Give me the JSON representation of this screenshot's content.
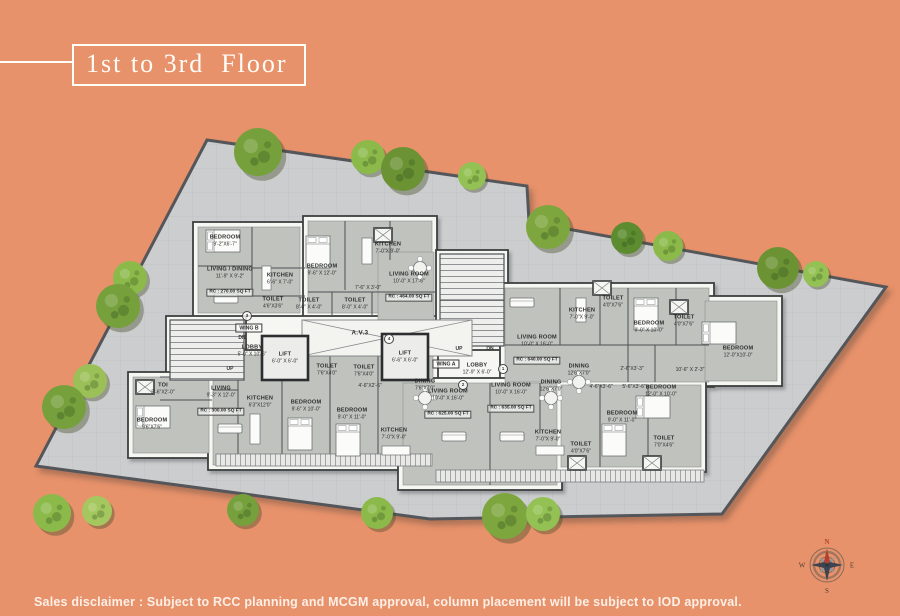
{
  "title": {
    "text": "1st to 3rd  Floor"
  },
  "disclaimer": {
    "text": "Sales disclaimer : Subject to RCC planning and MCGM approval, column placement will be subject to IOD approval."
  },
  "compass": {
    "n": "N",
    "e": "E",
    "s": "S",
    "w": "W"
  },
  "colors": {
    "background": "#e8926b",
    "plot_fill": "#cbcdcf",
    "building_fill": "#f6f6f3",
    "room_fill": "#bfc2bd",
    "wall": "#4e5054",
    "tree_greens": [
      "#76a03c",
      "#8cba4a",
      "#6b9334",
      "#93c153",
      "#7ea63f",
      "#9bc057"
    ],
    "accent_red": "#b5412f"
  },
  "plan": {
    "wing_a_label": "WING A",
    "wing_b_label": "WING B",
    "atrium_label": "A.V.3",
    "stair": {
      "up": "UP",
      "dn": "DN"
    },
    "door_tags": [
      "1",
      "2",
      "3",
      "4"
    ],
    "rooms": [
      {
        "name": "BEDROOM",
        "dims": "9'-2\"X6'-7\""
      },
      {
        "name": "LIVING / DINING",
        "dims": "11'-9\" X 9'-2\"",
        "area": "RC : 270.00 SQ FT"
      },
      {
        "name": "KITCHEN",
        "dims": "6'-6\" X 7'-0\""
      },
      {
        "name": "TOILET",
        "dims": "4'6\"X3'6\""
      },
      {
        "name": "BEDROOM",
        "dims": "9'-6\" X 12'-0\""
      },
      {
        "name": "KITCHEN",
        "dims": "7'-0\"X 9'-0\""
      },
      {
        "name": "TOILET",
        "dims": "8'-6\" X 4'-0\""
      },
      {
        "name": "TOILET",
        "dims": "8'-0\" X 4'-0\""
      },
      {
        "name": "",
        "dims": "7'-6\" X 3'-0\""
      },
      {
        "name": "LIVING ROOM",
        "dims": "10'-0\" X 17'-6\"",
        "area": "RC : 464.00 SQ FT"
      },
      {
        "name": "LOBBY",
        "dims": "5'-0\" X 10'-6\""
      },
      {
        "name": "LIFT",
        "dims": "6'-0\" X 6'-0\""
      },
      {
        "name": "TOILET",
        "dims": "7'6\"X4'0\""
      },
      {
        "name": "TOILET",
        "dims": "7'6\"X4'0\""
      },
      {
        "name": "LIFT",
        "dims": "6'-6\" X 6'-0\""
      },
      {
        "name": "LOBBY",
        "dims": "12'-9\" X 6'-0\""
      },
      {
        "name": "KITCHEN",
        "dims": "7'-0\"X 9'-0\""
      },
      {
        "name": "TOILET",
        "dims": "4'0\"X7'6\""
      },
      {
        "name": "BEDROOM",
        "dims": "9'-0\" X 10'-0\""
      },
      {
        "name": "LIVING ROOM",
        "dims": "10'-0\" X 16'-0\"",
        "area": "RC : 640.00 SQ FT"
      },
      {
        "name": "DINING",
        "dims": "12'6\"X7'0\""
      },
      {
        "name": "TOILET",
        "dims": "4'0\"X7'6\""
      },
      {
        "name": "BEDROOM",
        "dims": "12'-0\"X10'-0\""
      },
      {
        "name": "",
        "dims": "2'-6\"X3'-3\""
      },
      {
        "name": "",
        "dims": "10'-6\" X 2'-3\""
      },
      {
        "name": "BEDROOM",
        "dims": "12'-0\" X 10'-0\""
      },
      {
        "name": "BEDROOM",
        "dims": "9'-0\" X 11'-0\""
      },
      {
        "name": "TOILET",
        "dims": "7'0\"X4'6\""
      },
      {
        "name": "TOILET",
        "dims": "4'0\"X7'6\""
      },
      {
        "name": "",
        "dims": "4'-6\"X3'-6\""
      },
      {
        "name": "",
        "dims": "5'-6\"X3'-6\""
      },
      {
        "name": "TOI",
        "dims": "5'-6\"X2'-0\""
      },
      {
        "name": "BEDROOM",
        "dims": "9'6\"X7'6\""
      },
      {
        "name": "LIVING",
        "dims": "9'-3\" X 12'-0\"",
        "area": "RC : 300.00 SQ FT"
      },
      {
        "name": "KITCHEN",
        "dims": "6'3\"X12'0\""
      },
      {
        "name": "BEDROOM",
        "dims": "9'-6\" X 10'-0\""
      },
      {
        "name": "BEDROOM",
        "dims": "9'-0\" X 11'-0\""
      },
      {
        "name": "DINING",
        "dims": "7'6\"X7'0\""
      },
      {
        "name": "LIVING ROOM",
        "dims": "10'-0\" X 16'-0\"",
        "area": "RC : 625.00 SQ FT"
      },
      {
        "name": "LIVING ROOM",
        "dims": "10'-0\" X 16'-0\"",
        "area": "RC : 635.00 SQ FT"
      },
      {
        "name": "DINING",
        "dims": "12'6\"X7'0\""
      },
      {
        "name": "KITCHEN",
        "dims": "7'-0\"X 9'-0\""
      },
      {
        "name": "KITCHEN",
        "dims": "7'-0\"X 9'-0\""
      },
      {
        "name": "",
        "dims": "4'-6\"X2'-6\""
      }
    ]
  }
}
